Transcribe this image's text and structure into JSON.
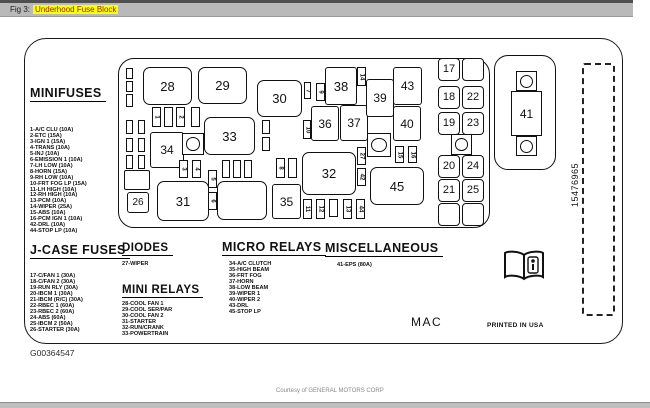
{
  "titlebar": {
    "prefix": "Fig 3:",
    "title": "Underhood Fuse Block",
    "highlight_color": "#ffff00",
    "bar_color": "#b9b9b9"
  },
  "figure": {
    "part_number": "15476965",
    "mac": "MAC",
    "printed": "PRINTED IN USA",
    "footnote": "G00364547",
    "courtesy": "Courtesy of GENERAL MOTORS CORP"
  },
  "legend": {
    "minifuses": {
      "heading": "MINIFUSES",
      "items": [
        "1-A/C CLU (10A)",
        "2-ETC (15A)",
        "3-IGN 1 (15A)",
        "4-TRANS (10A)",
        "5-INJ (10A)",
        "6-EMISSION 1 (10A)",
        "7-LH LOW (10A)",
        "8-HORN (15A)",
        "9-RH LOW (10A)",
        "10-FRT FOG LP (15A)",
        "11-LH HIGH (10A)",
        "12-RH HIGH (10A)",
        "13-PCM (10A)",
        "14-WIPER (25A)",
        "15-ABS (10A)",
        "16-PCM IGN 1 (10A)",
        "42-DRL (10A)",
        "44-STOP LP (10A)"
      ]
    },
    "jcase": {
      "heading": "J-CASE FUSES",
      "items": [
        "17-C/FAN 1 (30A)",
        "18-C/FAN 2 (30A)",
        "19-RUN RLY (30A)",
        "20-IBCM 1 (30A)",
        "21-IBCM (R/C) (30A)",
        "22-RBEC 1 (60A)",
        "23-RBEC 2 (60A)",
        "24-ABS (60A)",
        "25-IBCM 2 (50A)",
        "26-STARTER (30A)"
      ]
    },
    "diodes": {
      "heading": "DIODES",
      "items": [
        "27-WIPER"
      ]
    },
    "mini_relays": {
      "heading": "MINI RELAYS",
      "items": [
        "28-COOL FAN 1",
        "29-COOL SER/PAR",
        "30-COOL FAN 2",
        "31-STARTER",
        "32-RUN/CRANK",
        "33-POWERTRAIN"
      ]
    },
    "micro_relays": {
      "heading": "MICRO RELAYS",
      "items": [
        "34-A/C CLUTCH",
        "35-HIGH BEAM",
        "36-FRT FOG",
        "37-HORN",
        "38-LOW BEAM",
        "39-WIPER 1",
        "40-WIPER 2",
        "43-DRL",
        "45-STOP LP"
      ]
    },
    "miscellaneous": {
      "heading": "MISCELLANEOUS",
      "items": [
        "41-EPS (80A)"
      ]
    }
  },
  "panel": {
    "mega_fuse": {
      "label": "41"
    },
    "boxes": [
      {
        "label": "28",
        "x": 143,
        "y": 67,
        "w": 49,
        "h": 38,
        "r": 7,
        "fs": 13
      },
      {
        "label": "29",
        "x": 198,
        "y": 67,
        "w": 49,
        "h": 37,
        "r": 7,
        "fs": 13
      },
      {
        "label": "30",
        "x": 257,
        "y": 80,
        "w": 45,
        "h": 37,
        "r": 7,
        "fs": 13
      },
      {
        "label": "33",
        "x": 204,
        "y": 117,
        "w": 51,
        "h": 38,
        "r": 7,
        "fs": 13
      },
      {
        "label": "34",
        "x": 150,
        "y": 132,
        "w": 34,
        "h": 36,
        "r": 3,
        "fs": 12
      },
      {
        "label": "26",
        "x": 127,
        "y": 192,
        "w": 22,
        "h": 21,
        "r": 3,
        "fs": 10
      },
      {
        "label": "31",
        "x": 157,
        "y": 181,
        "w": 52,
        "h": 40,
        "r": 7,
        "fs": 13
      },
      {
        "label": "",
        "x": 217,
        "y": 181,
        "w": 50,
        "h": 39,
        "r": 7,
        "fs": 13
      },
      {
        "label": "35",
        "x": 272,
        "y": 184,
        "w": 29,
        "h": 35,
        "r": 3,
        "fs": 12
      },
      {
        "label": "36",
        "x": 311,
        "y": 106,
        "w": 28,
        "h": 35,
        "r": 3,
        "fs": 12
      },
      {
        "label": "37",
        "x": 340,
        "y": 105,
        "w": 28,
        "h": 36,
        "r": 3,
        "fs": 12
      },
      {
        "label": "38",
        "x": 325,
        "y": 67,
        "w": 32,
        "h": 38,
        "r": 3,
        "fs": 13
      },
      {
        "label": "39",
        "x": 366,
        "y": 79,
        "w": 28,
        "h": 38,
        "r": 3,
        "fs": 12
      },
      {
        "label": "40",
        "x": 393,
        "y": 106,
        "w": 28,
        "h": 35,
        "r": 3,
        "fs": 12
      },
      {
        "label": "43",
        "x": 393,
        "y": 67,
        "w": 29,
        "h": 38,
        "r": 3,
        "fs": 12
      },
      {
        "label": "32",
        "x": 302,
        "y": 152,
        "w": 54,
        "h": 43,
        "r": 7,
        "fs": 13
      },
      {
        "label": "45",
        "x": 370,
        "y": 167,
        "w": 54,
        "h": 38,
        "r": 7,
        "fs": 13
      },
      {
        "label": "",
        "x": 124,
        "y": 170,
        "w": 26,
        "h": 20,
        "r": 2,
        "fs": 10
      }
    ],
    "jcase_cells": [
      {
        "label": "17",
        "x": 438,
        "y": 58
      },
      {
        "label": "",
        "x": 462,
        "y": 58
      },
      {
        "label": "18",
        "x": 438,
        "y": 86
      },
      {
        "label": "22",
        "x": 462,
        "y": 86
      },
      {
        "label": "19",
        "x": 438,
        "y": 112
      },
      {
        "label": "23",
        "x": 462,
        "y": 112
      },
      {
        "label": "20",
        "x": 438,
        "y": 155
      },
      {
        "label": "24",
        "x": 462,
        "y": 155
      },
      {
        "label": "21",
        "x": 438,
        "y": 179
      },
      {
        "label": "25",
        "x": 462,
        "y": 179
      },
      {
        "label": "",
        "x": 438,
        "y": 203
      },
      {
        "label": "",
        "x": 462,
        "y": 203
      }
    ],
    "small_fuses": [
      {
        "label": "1",
        "x": 152,
        "y": 107
      },
      {
        "label": "",
        "x": 164,
        "y": 107
      },
      {
        "label": "2",
        "x": 176,
        "y": 107
      },
      {
        "label": "",
        "x": 191,
        "y": 107
      },
      {
        "label": "",
        "x": 126,
        "y": 68,
        "h": 11,
        "w": 7
      },
      {
        "label": "",
        "x": 126,
        "y": 81,
        "h": 11,
        "w": 7
      },
      {
        "label": "",
        "x": 126,
        "y": 94,
        "h": 13,
        "w": 7
      },
      {
        "label": "",
        "x": 126,
        "y": 120,
        "h": 14,
        "w": 7
      },
      {
        "label": "",
        "x": 126,
        "y": 138,
        "h": 14,
        "w": 7
      },
      {
        "label": "",
        "x": 126,
        "y": 155,
        "h": 14,
        "w": 7
      },
      {
        "label": "",
        "x": 138,
        "y": 120,
        "h": 14,
        "w": 7
      },
      {
        "label": "",
        "x": 138,
        "y": 138,
        "h": 14,
        "w": 7
      },
      {
        "label": "",
        "x": 138,
        "y": 155,
        "h": 14,
        "w": 7
      },
      {
        "label": "3",
        "x": 179,
        "y": 160,
        "h": 18
      },
      {
        "label": "4",
        "x": 192,
        "y": 160,
        "h": 18
      },
      {
        "label": "",
        "x": 222,
        "y": 160,
        "h": 18,
        "w": 8
      },
      {
        "label": "",
        "x": 233,
        "y": 160,
        "h": 18,
        "w": 8
      },
      {
        "label": "",
        "x": 244,
        "y": 160,
        "h": 18,
        "w": 8
      },
      {
        "label": "5",
        "x": 208,
        "y": 170,
        "h": 18
      },
      {
        "label": "6",
        "x": 208,
        "y": 192,
        "h": 18
      },
      {
        "label": "7",
        "x": 304,
        "y": 82,
        "h": 17,
        "w": 7
      },
      {
        "label": "9",
        "x": 316,
        "y": 83,
        "h": 18
      },
      {
        "label": "10",
        "x": 303,
        "y": 120,
        "h": 19,
        "w": 8
      },
      {
        "label": "",
        "x": 262,
        "y": 120,
        "h": 14,
        "w": 8
      },
      {
        "label": "",
        "x": 262,
        "y": 137,
        "h": 14,
        "w": 8
      },
      {
        "label": "8",
        "x": 276,
        "y": 158,
        "h": 20
      },
      {
        "label": "",
        "x": 288,
        "y": 158,
        "h": 20
      },
      {
        "label": "14",
        "x": 357,
        "y": 67,
        "h": 19
      },
      {
        "label": "27",
        "x": 357,
        "y": 147,
        "h": 18
      },
      {
        "label": "42",
        "x": 357,
        "y": 168,
        "h": 18
      },
      {
        "label": "15",
        "x": 395,
        "y": 146,
        "h": 17
      },
      {
        "label": "16",
        "x": 408,
        "y": 146,
        "h": 17
      },
      {
        "label": "11",
        "x": 303,
        "y": 199,
        "h": 20
      },
      {
        "label": "12",
        "x": 316,
        "y": 199,
        "h": 20
      },
      {
        "label": "",
        "x": 329,
        "y": 199,
        "h": 18
      },
      {
        "label": "13",
        "x": 343,
        "y": 199,
        "h": 20
      },
      {
        "label": "44",
        "x": 356,
        "y": 199,
        "h": 20
      }
    ],
    "bolts": [
      {
        "x": 182,
        "y": 133,
        "d": 22
      },
      {
        "x": 367,
        "y": 133,
        "d": 24
      },
      {
        "x": 451,
        "y": 134,
        "d": 21
      }
    ]
  }
}
